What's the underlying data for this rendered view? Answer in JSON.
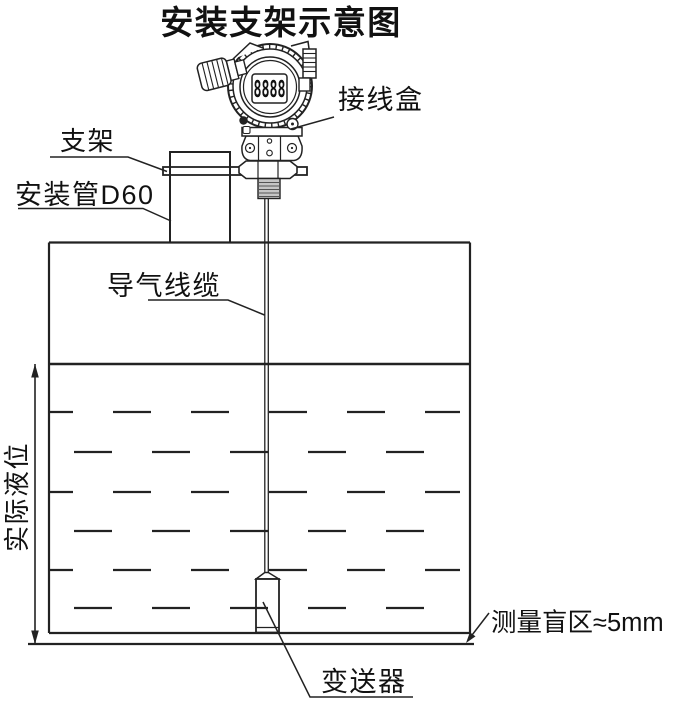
{
  "title": "安装支架示意图",
  "device": {
    "name": "液位变送器表头",
    "display_value": "8888"
  },
  "labels": {
    "junction_box": "接线盒",
    "bracket": "支架",
    "mounting_pipe": "安装管D60",
    "air_cable": "导气线缆",
    "actual_level": "实际液位",
    "transmitter": "变送器",
    "blind_zone": "测量盲区≈5mm"
  },
  "colors": {
    "background": "#ffffff",
    "line": "#222222",
    "text": "#111111",
    "thread_fill": "#c6c6c6"
  }
}
